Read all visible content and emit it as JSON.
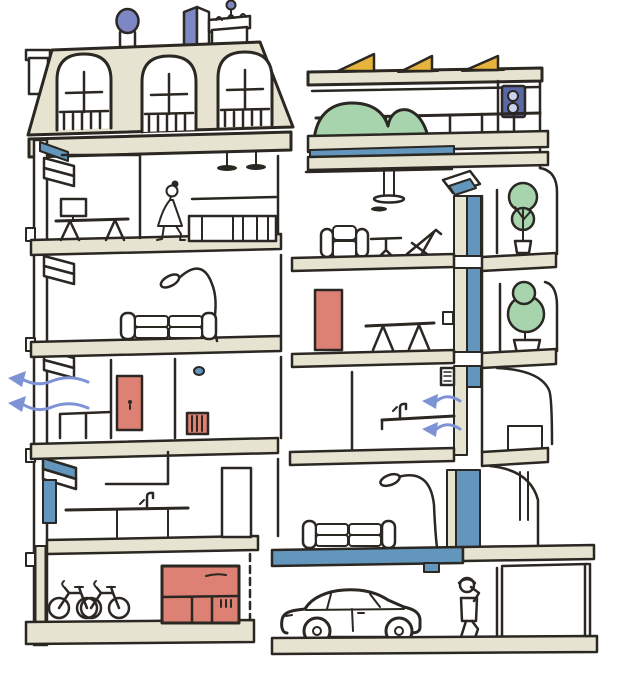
{
  "palette": {
    "ink": "#2b2722",
    "paper": "#ffffff",
    "slab": "#e7e3d1",
    "steel": "#6296bd",
    "periwinkle": "#7e93d6",
    "violet": "#7d87c4",
    "navy": "#5a68a8",
    "vent_circle": "#c9d3ee",
    "salmon": "#dc8174",
    "green": "#a7d4ad",
    "yellow": "#e6b33d"
  },
  "scene": {
    "type": "architectural-cross-section-illustration",
    "left_building": {
      "style": "old-mansard-roof-building",
      "roof_objects": [
        "mansard-roof",
        "dormer-window",
        "dormer-window",
        "dormer-window",
        "chimney-pipe",
        "roof-vent-box",
        "chimney-stack",
        "antenna-ball",
        "small-chimney"
      ],
      "floors_top_to_bottom": [
        {
          "objects": [
            "desk",
            "monitor",
            "walking-woman",
            "wall-shelf",
            "sideboard",
            "pendant-lamp",
            "pendant-lamp"
          ]
        },
        {
          "objects": [
            "arc-floor-lamp",
            "sofa",
            "window-sill"
          ]
        },
        {
          "objects": [
            "red-door",
            "wall-dot",
            "radiator",
            "low-cabinet",
            "window-sill",
            "air-leak-arrows"
          ]
        },
        {
          "objects": [
            "open-window-blue",
            "kitchen-counter",
            "faucet",
            "base-cabinets",
            "tall-cabinet"
          ]
        },
        {
          "objects": [
            "bicycle",
            "bicycle",
            "red-locker-cabinet"
          ]
        }
      ],
      "air_leak_arrow_count": 2,
      "air_leak_direction": "out-through-left-wall"
    },
    "right_building": {
      "style": "modern-insulated-building",
      "roof_objects": [
        "solar-panel",
        "solar-panel",
        "solar-panel",
        "green-roof-mounds",
        "roof-railing",
        "ventilation-unit"
      ],
      "floors_top_to_bottom": [
        {
          "objects": [
            "pendant-lamp",
            "armchair",
            "round-table",
            "deck-chair",
            "open-window-blue",
            "balcony-potted-tree"
          ]
        },
        {
          "objects": [
            "red-door",
            "trestle-table",
            "wall-socket",
            "balcony-round-tree"
          ]
        },
        {
          "objects": [
            "bathroom-counter",
            "faucet",
            "wall-vent-grille",
            "fresh-air-arrows",
            "curved-balcony"
          ]
        },
        {
          "objects": [
            "arc-floor-lamp",
            "sofa",
            "insulated-blue-slab"
          ]
        },
        {
          "objects": [
            "car",
            "person-on-phone",
            "garage-wall",
            "storage-room"
          ]
        }
      ],
      "fresh_air_arrow_count": 2,
      "fresh_air_direction": "in-through-wall-vent",
      "insulation": "blue-vertical-wall-strip"
    }
  }
}
